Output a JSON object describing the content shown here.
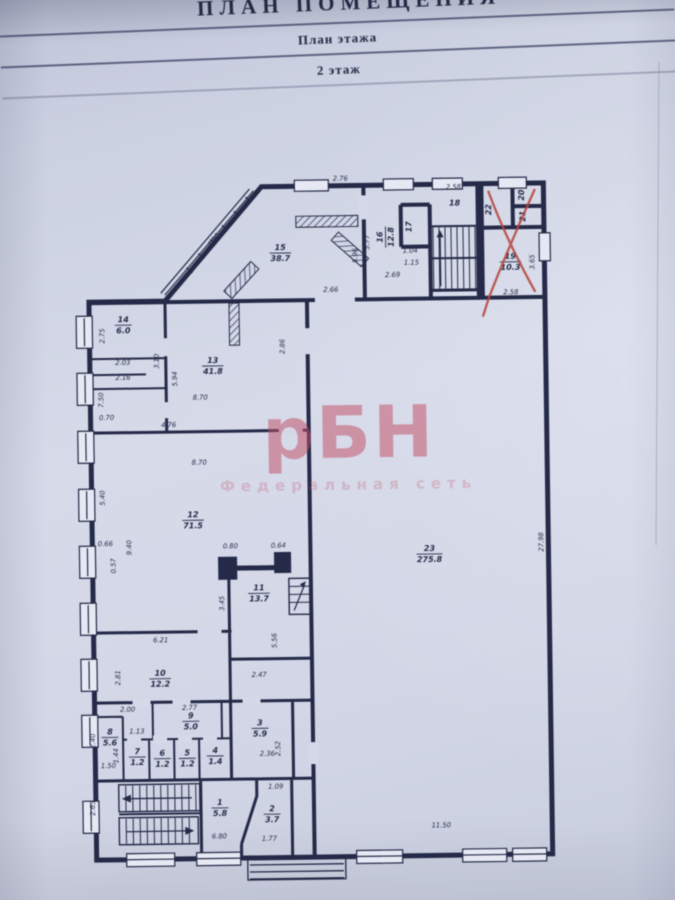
{
  "header": {
    "title": "ПЛАН ПОМЕЩЕНИЯ",
    "subtitle": "План этажа",
    "floor": "2 этаж"
  },
  "watermark": {
    "logo": "рБН",
    "tagline": "Федеральная сеть",
    "color": "#c14f66"
  },
  "colors": {
    "paper": "#d4d8e8",
    "ink": "#242a47",
    "red_annotation": "#b5463f"
  },
  "plan": {
    "rooms": [
      {
        "num": "1",
        "area": "5.8",
        "x": 216,
        "y": 806
      },
      {
        "num": "2",
        "area": "3.7",
        "x": 268,
        "y": 813
      },
      {
        "num": "3",
        "area": "5.9",
        "x": 257,
        "y": 727
      },
      {
        "num": "4",
        "area": "1.4",
        "x": 212,
        "y": 754
      },
      {
        "num": "5",
        "area": "1.2",
        "x": 184,
        "y": 756
      },
      {
        "num": "6",
        "area": "1.2",
        "x": 159,
        "y": 756
      },
      {
        "num": "7",
        "area": "1.2",
        "x": 134,
        "y": 754
      },
      {
        "num": "8",
        "area": "5.6",
        "x": 107,
        "y": 734
      },
      {
        "num": "9",
        "area": "5.0",
        "x": 188,
        "y": 719
      },
      {
        "num": "10",
        "area": "12.2",
        "x": 158,
        "y": 676
      },
      {
        "num": "11",
        "area": "13.7",
        "x": 258,
        "y": 592
      },
      {
        "num": "12",
        "area": "71.5",
        "x": 193,
        "y": 518
      },
      {
        "num": "13",
        "area": "41.8",
        "x": 215,
        "y": 364
      },
      {
        "num": "14",
        "area": "6.0",
        "x": 126,
        "y": 322
      },
      {
        "num": "15",
        "area": "38.7",
        "x": 284,
        "y": 252
      },
      {
        "num": "16",
        "area": "12.8",
        "x": 389,
        "y": 238,
        "r": -90
      },
      {
        "num": "17",
        "area": "",
        "x": 418,
        "y": 228,
        "r": -90
      },
      {
        "num": "18",
        "area": "",
        "x": 459,
        "y": 210
      },
      {
        "num": "19",
        "area": "10.3",
        "x": 514,
        "y": 264
      },
      {
        "num": "20",
        "area": "",
        "x": 531,
        "y": 198,
        "r": -90
      },
      {
        "num": "21",
        "area": "",
        "x": 532,
        "y": 219,
        "r": -90
      },
      {
        "num": "22",
        "area": "",
        "x": 498,
        "y": 212,
        "r": -90
      },
      {
        "num": "23",
        "area": "275.8",
        "x": 429,
        "y": 555
      }
    ],
    "dims": [
      {
        "t": "2.76",
        "x": 345,
        "y": 181
      },
      {
        "t": "2.58",
        "x": 458,
        "y": 191
      },
      {
        "t": "4.90",
        "x": 219,
        "y": 240,
        "r": -49
      },
      {
        "t": "5.96",
        "x": 361,
        "y": 256,
        "r": -90
      },
      {
        "t": "5.77",
        "x": 373,
        "y": 243,
        "r": -90
      },
      {
        "t": "1.04",
        "x": 414,
        "y": 254
      },
      {
        "t": "1.15",
        "x": 415,
        "y": 266
      },
      {
        "t": "2.69",
        "x": 396,
        "y": 278
      },
      {
        "t": "2.66",
        "x": 334,
        "y": 292
      },
      {
        "t": "3.65",
        "x": 538,
        "y": 265,
        "r": -90
      },
      {
        "t": "2.58",
        "x": 514,
        "y": 297
      },
      {
        "t": "2.86",
        "x": 287,
        "y": 346,
        "r": -90
      },
      {
        "t": "2.75",
        "x": 107,
        "y": 333,
        "r": -90
      },
      {
        "t": "2.03",
        "x": 125,
        "y": 362
      },
      {
        "t": "2.16",
        "x": 125,
        "y": 377
      },
      {
        "t": "3.10",
        "x": 161,
        "y": 359,
        "r": -90
      },
      {
        "t": "5.94",
        "x": 179,
        "y": 377,
        "r": -90
      },
      {
        "t": "8.70",
        "x": 202,
        "y": 398
      },
      {
        "t": "7.50",
        "x": 105,
        "y": 397,
        "r": -90
      },
      {
        "t": "0.70",
        "x": 108,
        "y": 417
      },
      {
        "t": "4.76",
        "x": 170,
        "y": 425
      },
      {
        "t": "8.70",
        "x": 200,
        "y": 463
      },
      {
        "t": "5.40",
        "x": 105,
        "y": 495,
        "r": -90
      },
      {
        "t": "0.66",
        "x": 105,
        "y": 543
      },
      {
        "t": "9.40",
        "x": 131,
        "y": 545,
        "r": -90
      },
      {
        "t": "0.57",
        "x": 115,
        "y": 563,
        "r": -90
      },
      {
        "t": "0.80",
        "x": 230,
        "y": 547
      },
      {
        "t": "0.64",
        "x": 278,
        "y": 547
      },
      {
        "t": "3.45",
        "x": 223,
        "y": 602,
        "r": -90
      },
      {
        "t": "5.56",
        "x": 275,
        "y": 640,
        "r": -90
      },
      {
        "t": "6.21",
        "x": 159,
        "y": 640
      },
      {
        "t": "2.81",
        "x": 118,
        "y": 675,
        "r": -90
      },
      {
        "t": "2.47",
        "x": 257,
        "y": 676
      },
      {
        "t": "2.00",
        "x": 125,
        "y": 709
      },
      {
        "t": "2.77",
        "x": 187,
        "y": 708
      },
      {
        "t": "1.13",
        "x": 134,
        "y": 731
      },
      {
        "t": "2.40",
        "x": 92,
        "y": 738,
        "r": -90
      },
      {
        "t": "1.44",
        "x": 115,
        "y": 753,
        "r": -90
      },
      {
        "t": "1.50",
        "x": 105,
        "y": 765
      },
      {
        "t": "2.36",
        "x": 264,
        "y": 755
      },
      {
        "t": "2.52",
        "x": 277,
        "y": 748,
        "r": -90
      },
      {
        "t": "2.63",
        "x": 91,
        "y": 805,
        "r": -90
      },
      {
        "t": "1.09",
        "x": 272,
        "y": 788
      },
      {
        "t": "6.80",
        "x": 215,
        "y": 837
      },
      {
        "t": "1.77",
        "x": 265,
        "y": 840
      },
      {
        "t": "11.50",
        "x": 437,
        "y": 829
      },
      {
        "t": "27.98",
        "x": 543,
        "y": 545,
        "r": -90
      }
    ]
  }
}
